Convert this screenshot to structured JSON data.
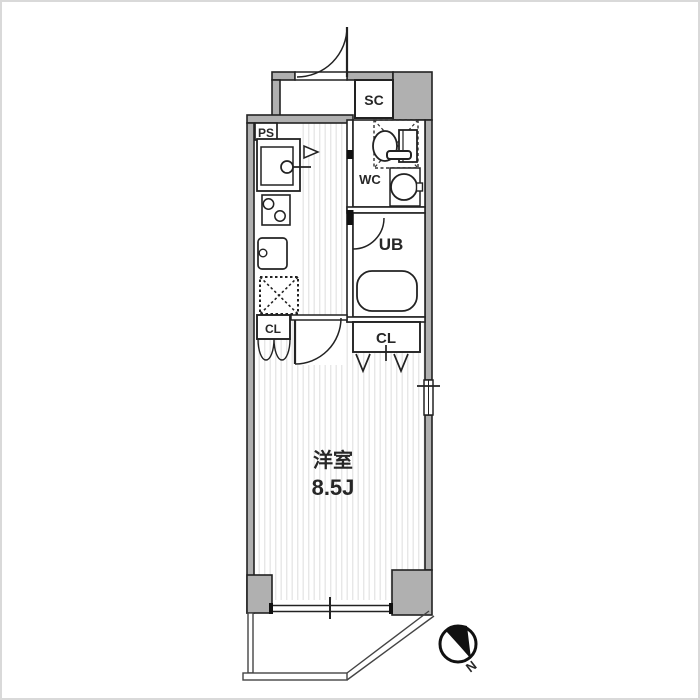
{
  "floor_plan": {
    "type": "apartment-floor-plan",
    "labels": {
      "shoe_closet": "SC",
      "pipe_space": "PS",
      "toilet_room": "WC",
      "unit_bath": "UB",
      "closet_kitchen": "CL",
      "closet_room": "CL",
      "room_name": "洋室",
      "room_size": "8.5J",
      "compass_north": "N"
    },
    "colors": {
      "wall_fill": "#b0b0b0",
      "outline": "#222222",
      "floor_stripe": "#e7e7e7",
      "background": "#ffffff",
      "frame_border": "#d9d9d9"
    }
  }
}
